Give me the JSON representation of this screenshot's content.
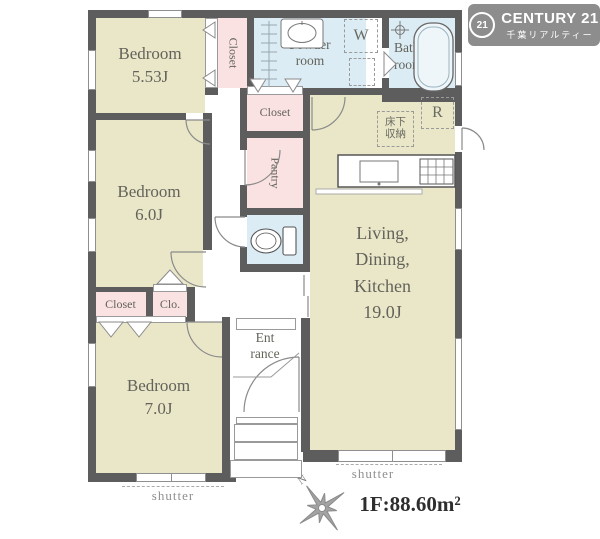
{
  "logo": {
    "badge_number": "21",
    "brand": "CENTURY 21",
    "subtitle": "千葉リアルティー"
  },
  "rooms": {
    "bedroom1": {
      "name": "Bedroom",
      "size": "5.53J"
    },
    "bedroom2": {
      "name": "Bedroom",
      "size": "6.0J"
    },
    "bedroom3": {
      "name": "Bedroom",
      "size": "7.0J"
    },
    "ldk": {
      "line1": "Living,",
      "line2": "Dining,",
      "line3": "Kitchen",
      "size": "19.0J"
    },
    "powder_room": {
      "line1": "Powder",
      "line2": "room"
    },
    "bath_room": {
      "line1": "Bath",
      "line2": "room"
    },
    "closet_top": {
      "name": "Closet"
    },
    "closet_mid": {
      "name": "Closet"
    },
    "closet_west": {
      "name": "Closet"
    },
    "closet_small": {
      "name": "Clo."
    },
    "pantry": {
      "name": "Pantry"
    },
    "entrance": {
      "line1": "Ent",
      "line2": "rance"
    }
  },
  "fixtures": {
    "washer_label": "W",
    "fridge_label": "R",
    "underfloor_storage": "床下収納"
  },
  "annotations": {
    "shutter_left": "shutter",
    "shutter_right": "shutter",
    "compass_north": "N",
    "floor_area": "1F:88.60m²"
  },
  "colors": {
    "wall": "#5d5d5d",
    "room_beige": "#eae7c9",
    "closet_pink": "#f9e2e1",
    "wet_blue": "#dcecf5",
    "logo_gray": "#8d8d8d"
  }
}
